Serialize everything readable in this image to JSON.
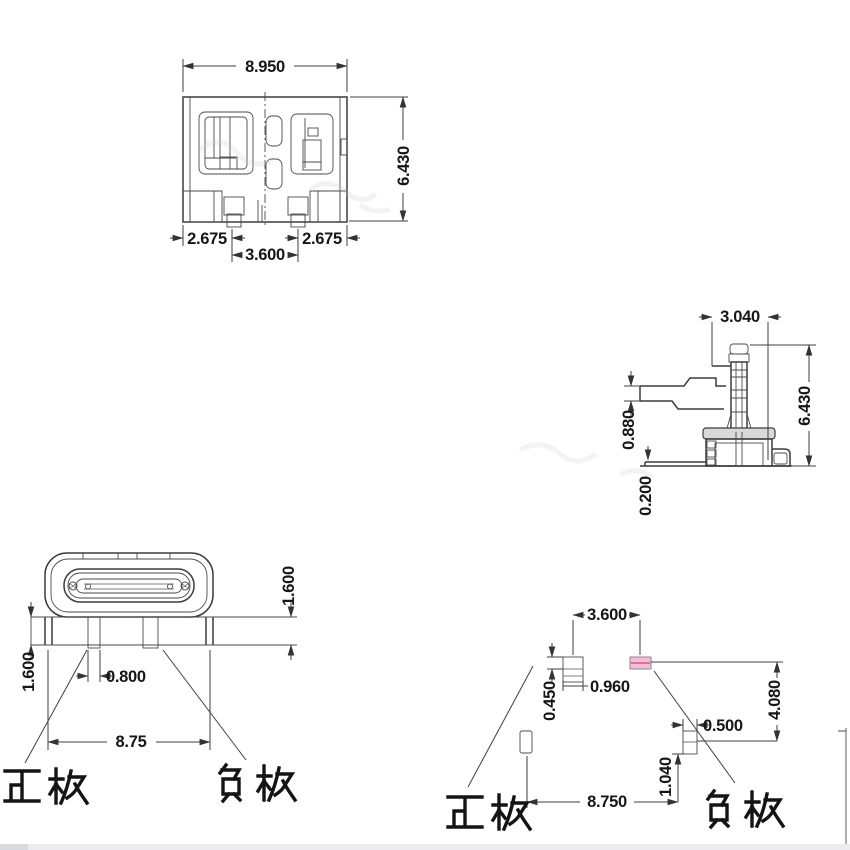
{
  "top": {
    "w": "8.950",
    "h": "6.430",
    "left": "2.675",
    "right": "2.675",
    "mid": "3.600"
  },
  "side": {
    "w": "3.040",
    "h": "6.430",
    "lead": "0.880",
    "standoff": "0.200"
  },
  "front": {
    "right_h": "1.600",
    "left_h": "1.600",
    "pin_w": "0.800",
    "span": "8.75",
    "positive": "正极",
    "negative": "负极"
  },
  "footprint": {
    "pitch": "3.600",
    "pad_w": "0.960",
    "pad_h": "0.450",
    "col": "4.080",
    "pad2_w": "0.500",
    "pad2_h": "1.040",
    "span": "8.750",
    "positive": "正极",
    "negative": "负极"
  },
  "colors": {
    "line": "#3c3c3c",
    "pad_fill": "#f4bdd4",
    "pad_line": "#d4549a"
  }
}
